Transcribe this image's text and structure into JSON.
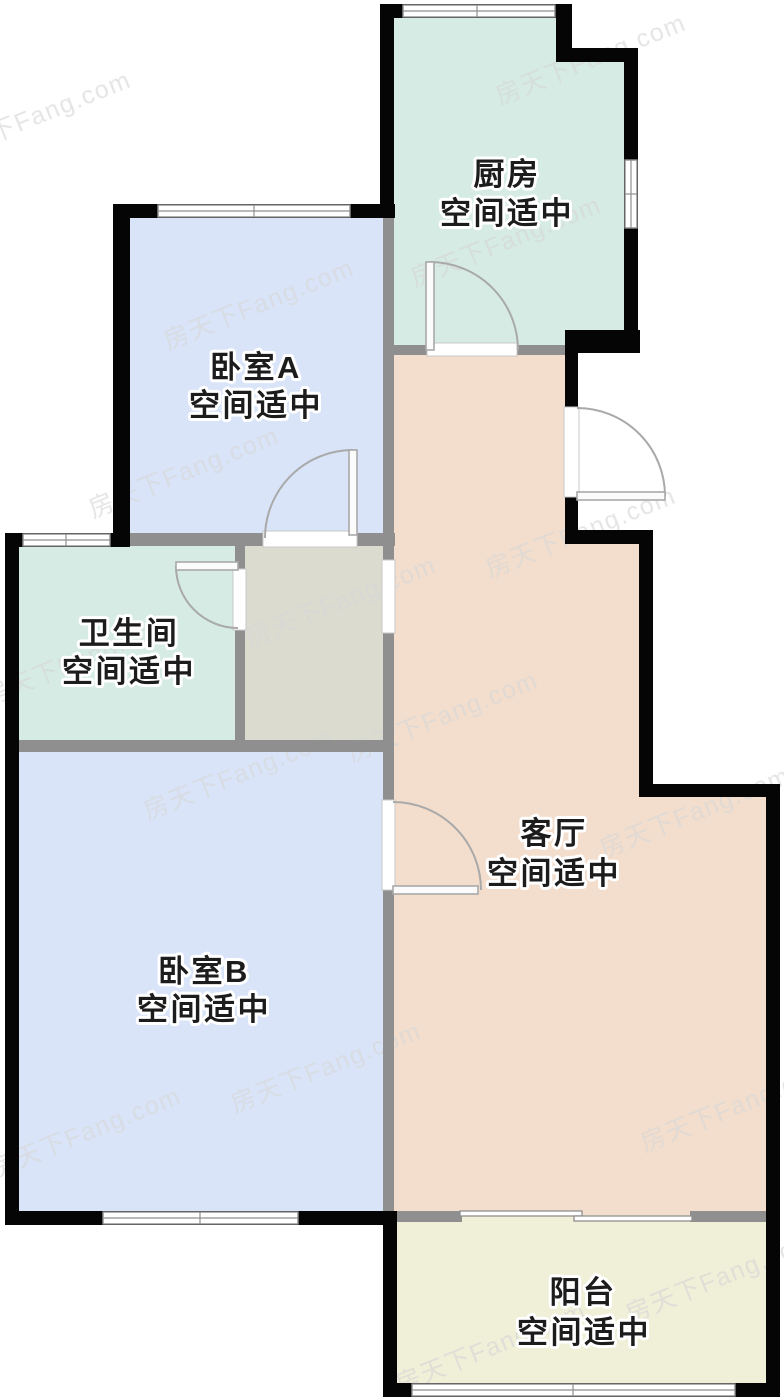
{
  "watermark": {
    "text": "房天下Fang.com"
  },
  "rooms": {
    "kitchen": {
      "name": "厨房",
      "note": "空间适中",
      "color": "#d5ebe3"
    },
    "bedroom_a": {
      "name": "卧室A",
      "note": "空间适中",
      "color": "#d9e4f9"
    },
    "bathroom": {
      "name": "卫生间",
      "note": "空间适中",
      "color": "#d5ebe3"
    },
    "living": {
      "name": "客厅",
      "note": "空间适中",
      "color": "#f3decd"
    },
    "bedroom_b": {
      "name": "卧室B",
      "note": "空间适中",
      "color": "#d9e4f9"
    },
    "balcony": {
      "name": "阳台",
      "note": "空间适中",
      "color": "#f0efd8"
    },
    "storage": {
      "color": "#dbdbcf"
    }
  },
  "palette": {
    "exterior_wall": "#050505",
    "interior_wall": "#8f8f8f",
    "window_line": "#8f8f8f",
    "door_line": "#a9a9a9",
    "label_text": "#1c1c1c",
    "watermark": "#d7d7d7"
  }
}
